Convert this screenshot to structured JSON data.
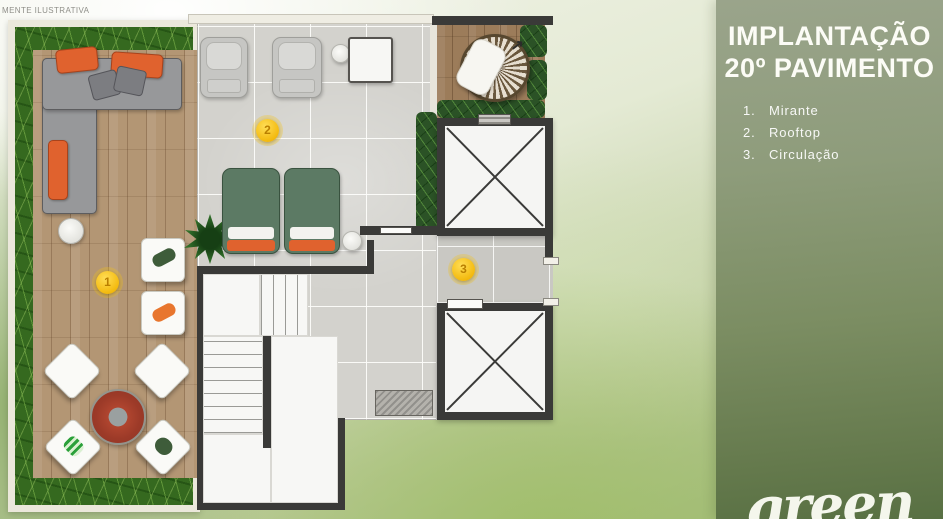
{
  "watermark": "MENTE ILUSTRATIVA",
  "panel": {
    "title_line1": "IMPLANTAÇÃO",
    "title_line2": "20º PAVIMENTO",
    "legend": [
      {
        "num": "1.",
        "label": "Mirante"
      },
      {
        "num": "2.",
        "label": "Rooftop"
      },
      {
        "num": "3.",
        "label": "Circulação"
      }
    ],
    "brand": "green"
  },
  "plan": {
    "markers": [
      {
        "n": "1",
        "area": "Mirante"
      },
      {
        "n": "2",
        "area": "Rooftop"
      },
      {
        "n": "3",
        "area": "Circulação"
      }
    ]
  },
  "colors": {
    "marker_yellow": "#f3b90d",
    "marker_number": "#b97f00",
    "panel_green": "#7b8d62",
    "grass_green": "#35691f",
    "hedge_green": "#2b5226",
    "deck_wood": "#b39674",
    "tile_gray": "#d3d2cd",
    "wall_dark": "#3a3a38",
    "accent_orange": "#e0622e",
    "lounger_green": "#5c7a64",
    "table_red": "#9c3a28"
  }
}
